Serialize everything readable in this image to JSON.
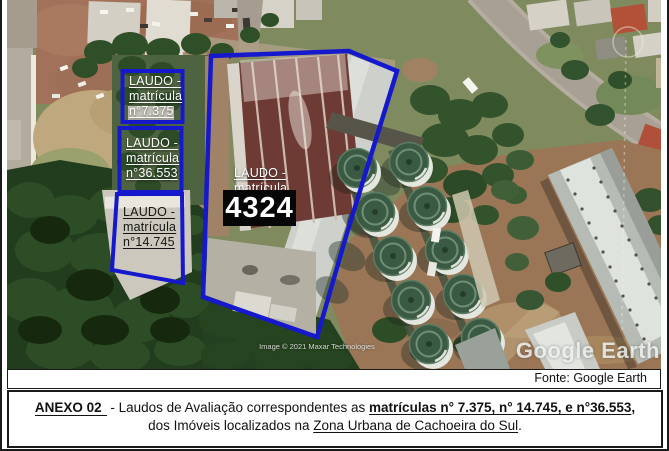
{
  "figure": {
    "watermark": "Google Earth",
    "copyright": "Image © 2021 Maxar Technologies",
    "annotations": {
      "a7375": {
        "l1": "LAUDO -",
        "l2": "matrícula",
        "l3": "n°7.375"
      },
      "a36553": {
        "l1": "LAUDO -",
        "l2": "matrícula",
        "l3": "n°36.553"
      },
      "a14745": {
        "l1": "LAUDO -",
        "l2": "matrícula",
        "l3": "n°14.745"
      },
      "main": {
        "l1": "LAUDO -",
        "l2": "matrícula",
        "number": "4324"
      }
    },
    "colors": {
      "annotation_blue": "#1518cc",
      "highlight_box_bg": "#060606",
      "highlight_box_text": "#ffffff"
    }
  },
  "caption": {
    "text": "Fonte: Google Earth"
  },
  "anexo": {
    "label": "ANEXO 02",
    "seg1": " - Laudos de Avaliação correspondentes as ",
    "matriculas": "matrículas n° 7.375, n° 14.745, e n°36.553",
    "seg2": ",",
    "line2_pre": "dos Imóveis localizados na ",
    "line2_em": "Zona Urbana de Cachoeira do Sul",
    "line2_post": "."
  }
}
